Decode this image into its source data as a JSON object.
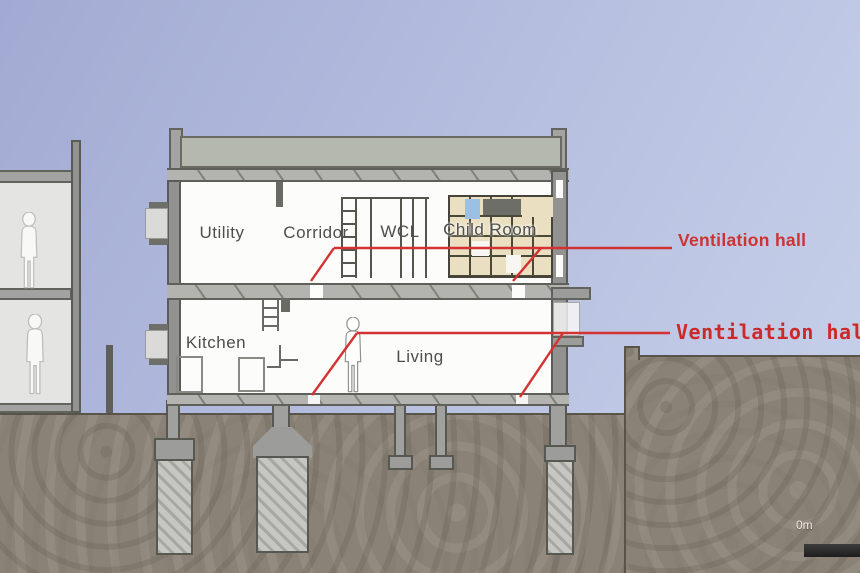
{
  "scene": {
    "description": "Architectural cross-section of a two-storey house on piles with neighbouring building and ground profile"
  },
  "rooms": {
    "upper": [
      {
        "label": "Utility"
      },
      {
        "label": "Corridor"
      },
      {
        "label": "WCL"
      },
      {
        "label": "Child Room"
      }
    ],
    "lower": [
      {
        "label": "Kitchen"
      },
      {
        "label": "Living"
      }
    ]
  },
  "annotations": {
    "upper": {
      "label": "Ventilation hall"
    },
    "lower": {
      "label": "Ventilation hall"
    },
    "line_color": "#d23232"
  },
  "scale_bar": {
    "label": "0m"
  },
  "colors": {
    "annotation_red": "#d23232",
    "sky_top": "#a2aad3",
    "sky_bottom": "#c9d2ea",
    "soil": "#8b8277",
    "roof_fill": "#b5b8af"
  }
}
